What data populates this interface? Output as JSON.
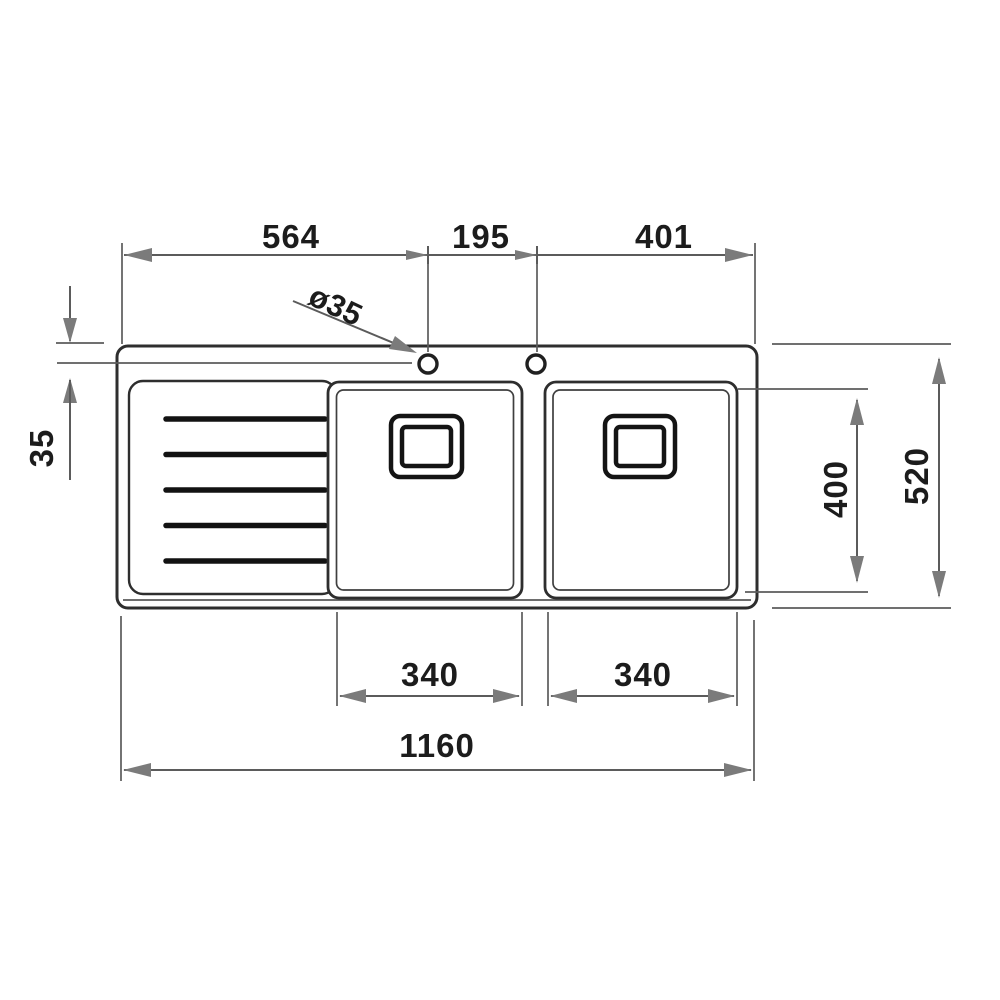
{
  "drawing": {
    "kind": "sink-plan-technical-drawing",
    "colors": {
      "background": "#ffffff",
      "outline": "#2e2e2e",
      "dimension_line": "#5b5b5b",
      "arrowhead": "#7b7b7b",
      "label_text": "#1c1c1c"
    },
    "dims": {
      "top_left": "564",
      "tap_hole_spacing": "195",
      "top_right": "401",
      "hole_diameter": "ø35",
      "hole_back_offset": "35",
      "bowl_depth": "400",
      "overall_depth": "520",
      "left_bowl_width": "340",
      "right_bowl_width": "340",
      "overall_width": "1160"
    }
  }
}
